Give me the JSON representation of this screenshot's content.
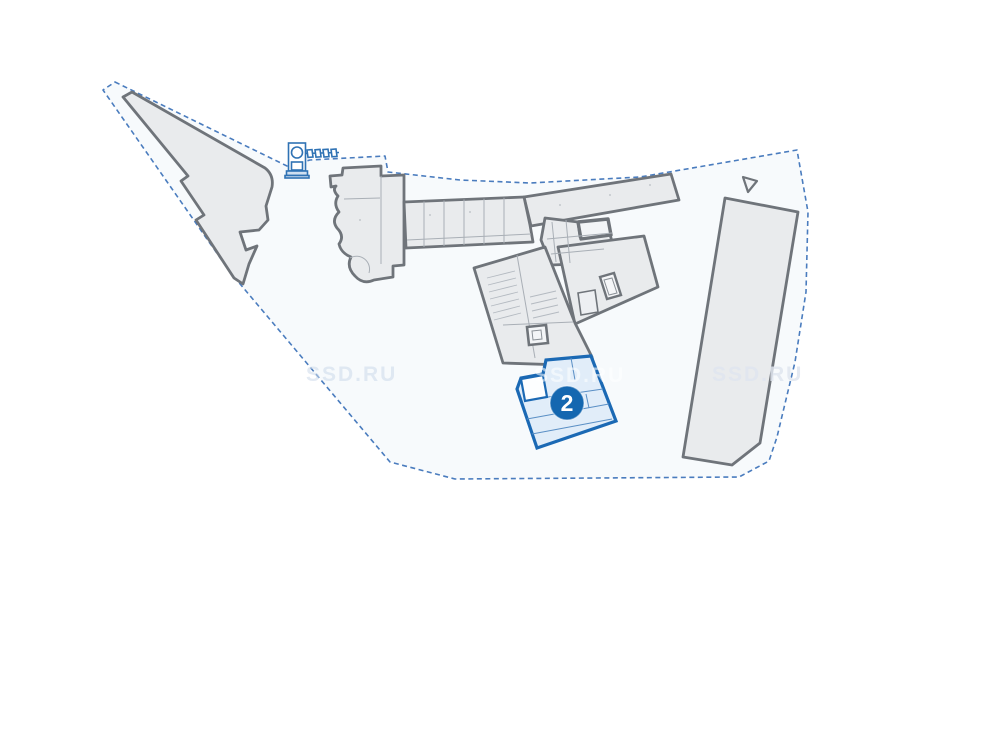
{
  "plan": {
    "watermark": {
      "text": "SSD.RU"
    },
    "selected_section": {
      "badge": "2"
    },
    "colors": {
      "page_bg": "#ffffff",
      "boundary_dash": "#4a7cbe",
      "boundary_fill": "#eef3f9",
      "building_fill": "#e9ebed",
      "building_stroke": "#6f747a",
      "selected_fill": "#e1edf9",
      "selected_stroke": "#1b69b4",
      "badge_bg": "#1467b0",
      "badge_text": "#ffffff",
      "barrier_icon_blue": "#2f72b4"
    },
    "icons": {
      "entrance": "boom-barrier-icon",
      "direction_marker": "triangle-marker-icon"
    }
  }
}
